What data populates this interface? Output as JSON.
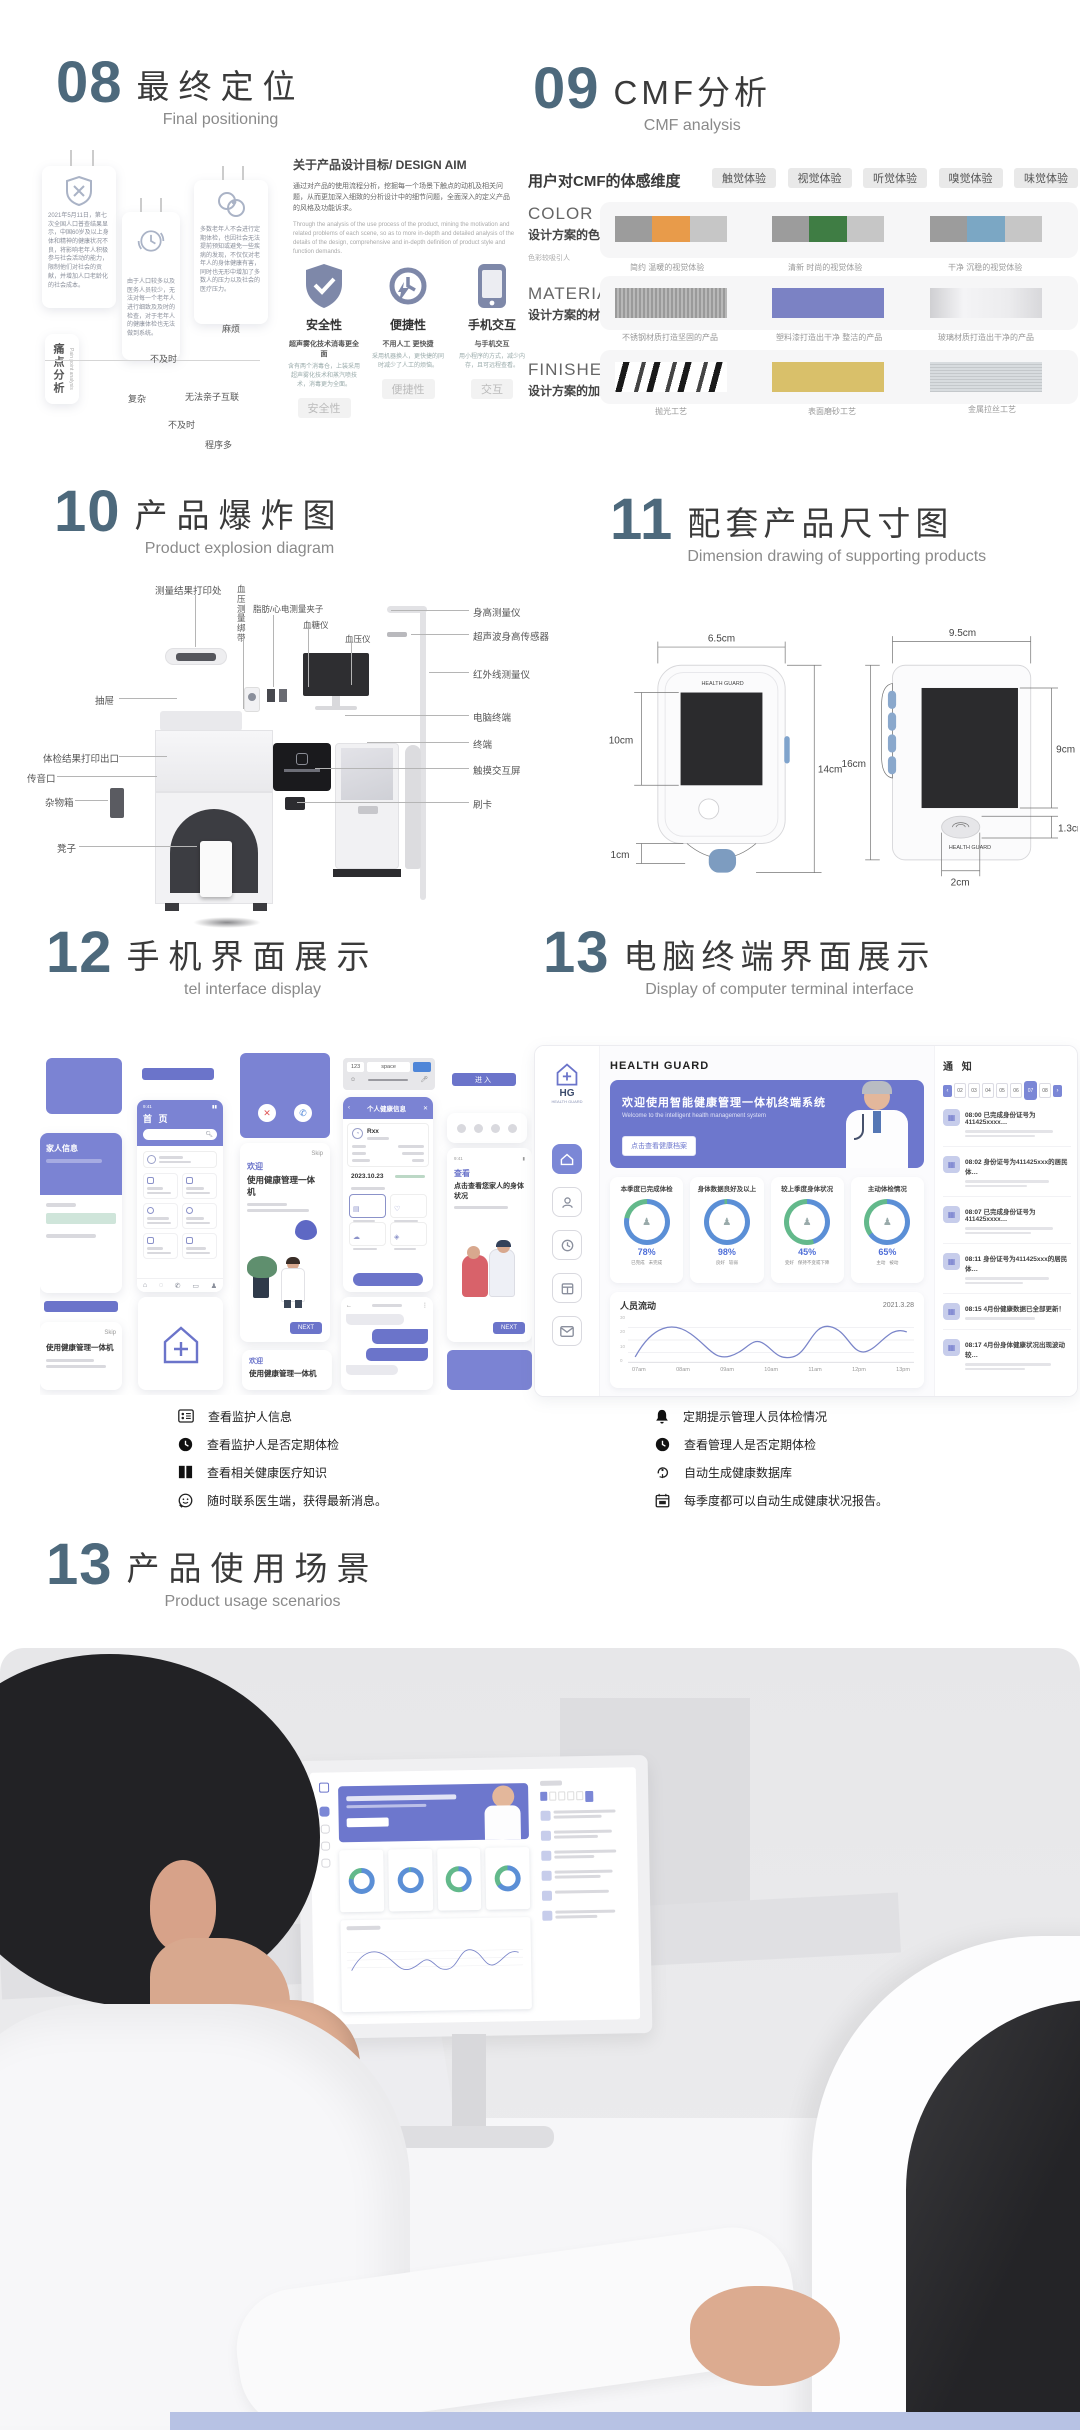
{
  "colors": {
    "number": "#4d697c",
    "purple": "#6b74ca",
    "orange": "#e89b4a",
    "green": "#3f7d44",
    "blue": "#7ba7c4",
    "gold": "#d9c06a",
    "bottom_strip": "#b7c2e4"
  },
  "s08": {
    "number": "08",
    "title": "最终定位",
    "subtitle": "Final positioning",
    "aim_title": "关于产品设计目标/ DESIGN AIM",
    "aim_zh": "通过对产品的使用流程分析，挖掘每一个场景下触点的动机及相关问题，从而更加深入细致的分析设计中的细节问题，全面深入的定义产品的风格及功能诉求。",
    "aim_en": "Through the analysis of the use process of the product, mining the motivation and related problems of each scene, so as to more in-depth and detailed analysis of the details of the design, comprehensive and in-depth definition of product style and function demands.",
    "pain_zh": "痛点分析",
    "pain_en": "Pain point analysis",
    "cards": [
      {
        "text": "2021年5月11日，第七次全国人口普查结果显示，中国60岁及以上身体和精神的健康状况不良，将影响老年人积极参与社会活动的能力，限制他们对社会的贡献，并增加人口老龄化的社会成本。"
      },
      {
        "text": "由于人口较多以及医务人员较少，无法对每一个老年人进行细致及及时的检查，对于老年人的健康体检也无法做到系统。"
      },
      {
        "text": "多数老年人不会进行定期体检，也因社会无法提前预知或避免一些疾病的发现，不仅仅对老年人的身体健康有害，同时也无形中增加了多数人的压力以及社会的医疗压力。"
      }
    ],
    "tags": [
      "麻烦",
      "不及时",
      "复杂",
      "无法亲子互联",
      "不及时",
      "程序多"
    ],
    "features": [
      {
        "label": "安全性",
        "caption": "超声雾化技术消毒更全面",
        "desc": "含有两个消毒仓，上装采用超声雾化技术和蒸汽喷技术，消毒更为全面。",
        "tag": "安全性"
      },
      {
        "label": "便捷性",
        "caption": "不用人工 更快捷",
        "desc": "采用机器换人，更快捷的同时减少了人工的烦恼。",
        "tag": "便捷性"
      },
      {
        "label": "手机交互",
        "caption": "与手机交互",
        "desc": "用小程序的方式，减少内存，且可远程查看。",
        "tag": "交互"
      }
    ]
  },
  "s09": {
    "number": "09",
    "title": "CMF分析",
    "subtitle": "CMF analysis",
    "dim_label": "用户对CMF的体感维度",
    "chips": [
      "触觉体验",
      "视觉体验",
      "听觉体验",
      "嗅觉体验",
      "味觉体验"
    ],
    "color_key": "COLOR",
    "color_sub": "设计方案的色彩方案",
    "color_note": "色彩较吸引人",
    "color_caps": [
      "简约 温暖的视觉体验",
      "清新 时尚的视觉体验",
      "干净 沉稳的视觉体验"
    ],
    "material_key": "MATERIAL",
    "material_sub": "设计方案的材料选择",
    "material_caps": [
      "不锈钢材质打造坚固的产品",
      "塑料漆打造出干净 整洁的产品",
      "玻璃材质打造出干净的产品"
    ],
    "finished_key": "FINISHED",
    "finished_sub": "设计方案的加工工艺",
    "finished_caps": [
      "抛光工艺",
      "表面磨砂工艺",
      "金属拉丝工艺"
    ]
  },
  "s10": {
    "number": "10",
    "title": "产品爆炸图",
    "subtitle": "Product explosion diagram",
    "top": [
      "测量结果打印处",
      "血压测量绑带",
      "脂肪/心电测量夹子",
      "血糖仪",
      "血压仪"
    ],
    "left": [
      "抽屉",
      "体检结果打印出口",
      "传音口",
      "杂物箱",
      "凳子"
    ],
    "right": [
      "身高测量仪",
      "超声波身高传感器",
      "红外线测量仪",
      "电脑终端",
      "终端",
      "触摸交互屏",
      "刷卡"
    ]
  },
  "s11": {
    "number": "11",
    "title": "配套产品尺寸图",
    "subtitle": "Dimension drawing of supporting products",
    "a": {
      "w": "6.5cm",
      "screen": "10cm",
      "h": "14cm",
      "foot": "1cm"
    },
    "b": {
      "w": "9.5cm",
      "h": "16cm",
      "screen": "9cm",
      "fp_h": "1.3cm",
      "fp_w": "2cm"
    }
  },
  "s12": {
    "number": "12",
    "title": "手机界面展示",
    "subtitle": "tel interface display",
    "status_time": "9:41",
    "family_info": "家人信息",
    "home_title": "首 页",
    "welcome_title": "欢迎",
    "welcome_sub": "使用健康管理一体机",
    "next": "NEXT",
    "profile_title": "个人健康信息",
    "profile_name": "Rxx",
    "profile_date": "2023.10.23",
    "enter": "进入",
    "view_title": "查看",
    "view_sub": "点击查看您家人的身体状况",
    "key_num": "123",
    "key_space": "space"
  },
  "s13": {
    "number": "13",
    "title": "电脑终端界面展示",
    "subtitle": "Display of computer terminal interface",
    "dashboard": {
      "brand": "HEALTH GUARD",
      "logo_hg": "HG",
      "logo_small": "HEALTH GUARD",
      "banner_title": "欢迎使用智能健康管理一体机终端系统",
      "banner_sub": "Welcome to the intelligent health management system",
      "banner_btn": "点击查看健康档案",
      "stats": [
        {
          "label": "本季度已完成体检",
          "value": "78%",
          "l1": "已完成",
          "l2": "未完成",
          "p": 78
        },
        {
          "label": "身体数据良好及以上",
          "value": "98%",
          "l1": "良好",
          "l2": "较弱",
          "p": 98
        },
        {
          "label": "较上季度身体状况",
          "value": "45%",
          "l1": "变好",
          "l2": "保持不变或下降",
          "p": 45
        },
        {
          "label": "主动体检情况",
          "value": "65%",
          "l1": "主动",
          "l2": "被动",
          "p": 65
        }
      ],
      "chart": {
        "type": "line",
        "title": "人员流动",
        "date": "2021.3.28",
        "x": [
          "07am",
          "08am",
          "09am",
          "10am",
          "11am",
          "12pm",
          "13pm"
        ],
        "values_est": [
          5,
          30,
          12,
          22,
          32,
          14,
          30
        ],
        "y_ticks": [
          "30",
          "20",
          "10",
          "0"
        ],
        "ylim": [
          0,
          30
        ]
      },
      "notice_title": "通 知",
      "chips": [
        "02",
        "03",
        "04",
        "05",
        "06",
        "07",
        "08"
      ],
      "notices": [
        {
          "time": "08:00",
          "text": "已完成身份证号为411425xxxx…"
        },
        {
          "time": "08:02",
          "text": "身份证号为411425xxx的居民体…"
        },
        {
          "time": "08:07",
          "text": "已完成身份证号为411425xxxx…"
        },
        {
          "time": "08:11",
          "text": "身份证号为411425xxx的居民体…"
        },
        {
          "time": "08:15",
          "text": "4月份健康数据已全部更新！"
        },
        {
          "time": "08:17",
          "text": "4月份身体健康状况出现波动较…"
        }
      ]
    }
  },
  "legend": {
    "left": [
      {
        "text": "查看监护人信息"
      },
      {
        "text": "查看监护人是否定期体检"
      },
      {
        "text": "查看相关健康医疗知识"
      },
      {
        "text": "随时联系医生端，获得最新消息。"
      }
    ],
    "right": [
      {
        "text": "定期提示管理人员体检情况"
      },
      {
        "text": "查看管理人是否定期体检"
      },
      {
        "text": "自动生成健康数据库"
      },
      {
        "text": "每季度都可以自动生成健康状况报告。"
      }
    ]
  },
  "s13b": {
    "number": "13",
    "title": "产品使用场景",
    "subtitle": "Product usage scenarios"
  }
}
